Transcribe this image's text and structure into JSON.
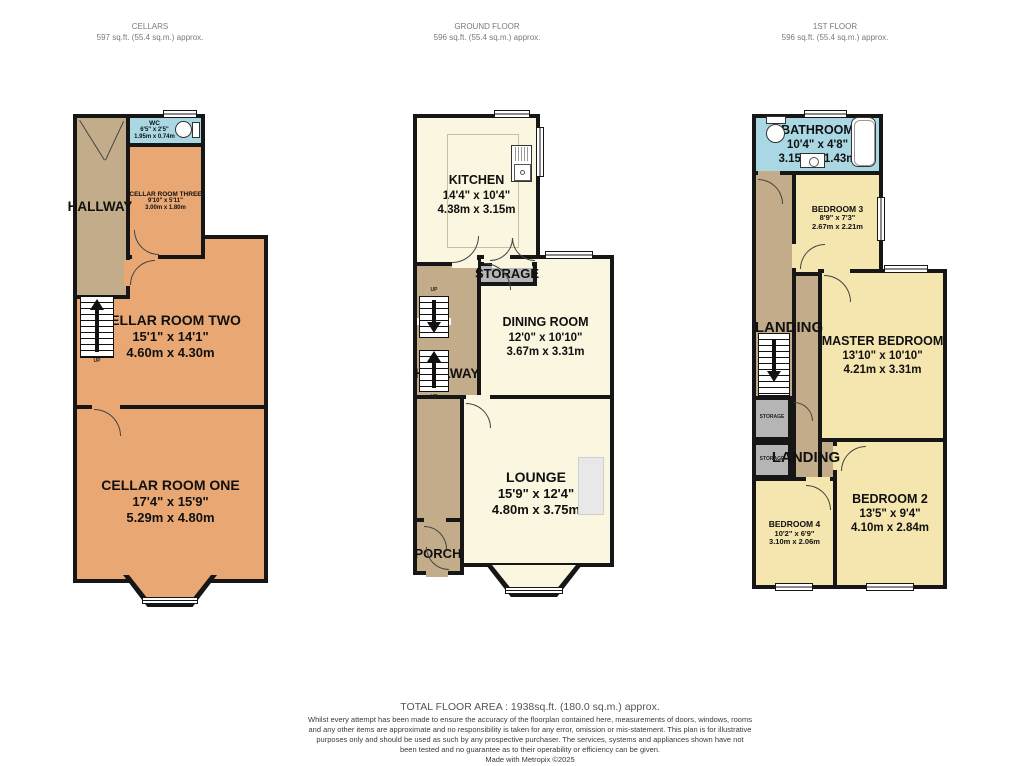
{
  "floors": [
    {
      "title": "CELLARS",
      "subtitle": "597 sq.ft. (55.4 sq.m.) approx."
    },
    {
      "title": "GROUND FLOOR",
      "subtitle": "596 sq.ft. (55.4 sq.m.) approx."
    },
    {
      "title": "1ST FLOOR",
      "subtitle": "596 sq.ft. (55.4 sq.m.) approx."
    }
  ],
  "rooms": {
    "wc": {
      "name": "WC",
      "imperial": "6'5\" x 2'5\"",
      "metric": "1.95m x 0.74m"
    },
    "cellar_room_three": {
      "name": "CELLAR ROOM THREE",
      "imperial": "9'10\" x 5'11\"",
      "metric": "3.00m x 1.80m"
    },
    "cellar_room_two": {
      "name": "CELLAR ROOM TWO",
      "imperial": "15'1\" x 14'1\"",
      "metric": "4.60m x 4.30m"
    },
    "cellar_room_one": {
      "name": "CELLAR ROOM ONE",
      "imperial": "17'4\" x 15'9\"",
      "metric": "5.29m x 4.80m"
    },
    "kitchen": {
      "name": "KITCHEN",
      "imperial": "14'4\" x 10'4\"",
      "metric": "4.38m x 3.15m"
    },
    "dining_room": {
      "name": "DINING ROOM",
      "imperial": "12'0\" x 10'10\"",
      "metric": "3.67m x 3.31m"
    },
    "lounge": {
      "name": "LOUNGE",
      "imperial": "15'9\" x 12'4\"",
      "metric": "4.80m x 3.75m"
    },
    "bathroom": {
      "name": "BATHROOM",
      "imperial": "10'4\" x 4'8\"",
      "metric": "3.15m x 1.43m"
    },
    "bedroom_3": {
      "name": "BEDROOM 3",
      "imperial": "8'9\" x 7'3\"",
      "metric": "2.67m x 2.21m"
    },
    "master_bedroom": {
      "name": "MASTER BEDROOM",
      "imperial": "13'10\" x 10'10\"",
      "metric": "4.21m x 3.31m"
    },
    "bedroom_4": {
      "name": "BEDROOM 4",
      "imperial": "10'2\" x 6'9\"",
      "metric": "3.10m x 2.06m"
    },
    "bedroom_2": {
      "name": "BEDROOM 2",
      "imperial": "13'5\" x 9'4\"",
      "metric": "4.10m x 2.84m"
    }
  },
  "zone_labels": {
    "hallway": "HALLWAY",
    "stairs": "STAIRS",
    "up": "UP",
    "storage": "STORAGE",
    "porch": "PORCH",
    "landing": "LANDING"
  },
  "footer": {
    "total": "TOTAL FLOOR AREA : 1938sq.ft. (180.0 sq.m.) approx.",
    "disclaimer": "Whilst every attempt has been made to ensure the accuracy of the floorplan contained here, measurements of doors, windows, rooms and any other items are approximate and no responsibility is taken for any error, omission or mis-statement. This plan is for illustrative purposes only and should be used as such by any prospective purchaser. The services, systems and appliances shown have not been tested and no guarantee as to their operability or efficiency can be given.",
    "credit": "Made with Metropix ©2025"
  },
  "colors": {
    "wall": "#161616",
    "cellar_room": "#E9A873",
    "hallway_tan": "#C3AC89",
    "wet_room_blue": "#A9D8E4",
    "living_cream": "#FAF6DF",
    "bedroom_yellow": "#F5E6AF",
    "storage_gray": "#B5B5B5",
    "header_text": "#7A7A7A"
  }
}
